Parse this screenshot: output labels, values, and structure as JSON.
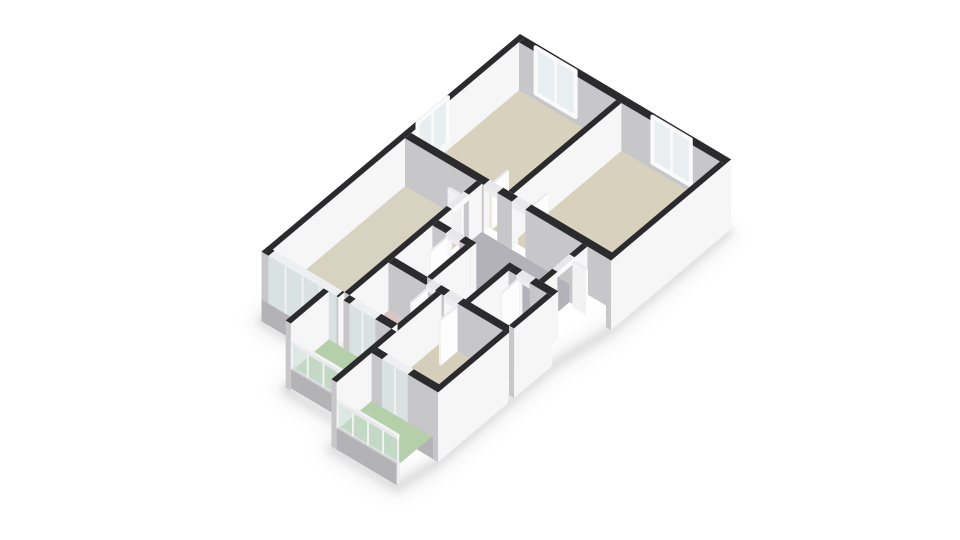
{
  "app": {
    "kind": "3d-floorplan-render",
    "background": "#ffffff"
  },
  "scene": {
    "projection": {
      "ox": 520,
      "oy": 34,
      "ex": [
        32,
        19
      ],
      "ey": [
        -38,
        32
      ],
      "wallH": 48
    },
    "palette": {
      "kinds": {
        "wall": {
          "top": "#2b2b2d",
          "fx": "#f6f6f7",
          "fy": "#c7c7ca"
        },
        "glazed": {
          "top": "#edeff0",
          "fx": "#fbfbfc",
          "fy": "#d9e2e0"
        },
        "leaf": {
          "top": "#ebebed",
          "fx": "#fdfdfd",
          "fy": "#f2f2f3"
        },
        "header": {
          "top": "#e8e8ea",
          "fx": "#fbfbfc",
          "fy": "#ededef"
        },
        "plinth": {
          "top": "#c9c9cc",
          "fx": "#ededef",
          "fy": "#b3b3b6"
        },
        "rail": {
          "top": "#f3f3f4",
          "fx": "#ffffff",
          "fy": "#e9e9eb"
        }
      },
      "windowGlass": "#e9eef0",
      "windowFrame": "#fafafa",
      "railGlass": "rgba(205,222,213,0.62)",
      "railGlassEdge": "#e6ebe8",
      "railPost": "#f0f1f0",
      "shadow": "#9b9b9b"
    },
    "floors": [
      {
        "id": "floor-bedroom-top-left",
        "color": "#d8d1bd",
        "rect": [
          0.16,
          0.16,
          3.2,
          3.0
        ]
      },
      {
        "id": "floor-bedroom-top-right",
        "color": "#d8d1bd",
        "rect": [
          3.36,
          0.16,
          6.44,
          3.0
        ]
      },
      {
        "id": "floor-living-room",
        "color": "#d8d2c0",
        "rect": [
          0.16,
          3.16,
          2.4,
          6.64
        ]
      },
      {
        "id": "floor-hallway-main",
        "color": "#b3b2b9",
        "rect": [
          2.56,
          3.16,
          5.7,
          4.3
        ]
      },
      {
        "id": "floor-hallway-arm",
        "color": "#b3b2b9",
        "rect": [
          3.74,
          4.3,
          4.78,
          5.46
        ]
      },
      {
        "id": "floor-bathroom",
        "color": "#b7cdd9",
        "rect": [
          2.56,
          4.46,
          3.58,
          5.46
        ]
      },
      {
        "id": "floor-toilet",
        "color": "#b7cdd9",
        "rect": [
          4.94,
          4.46,
          6.14,
          5.46
        ]
      },
      {
        "id": "floor-bedroom-pink",
        "color": "#d8c6c3",
        "rect": [
          2.56,
          5.62,
          4.06,
          6.64
        ]
      },
      {
        "id": "floor-bedroom-bottom",
        "color": "#d5cebb",
        "rect": [
          4.22,
          5.62,
          6.14,
          7.3
        ]
      },
      {
        "id": "floor-balcony-upper",
        "color": "#b4cfaa",
        "rect": [
          2.1,
          6.8,
          4.06,
          7.72
        ]
      },
      {
        "id": "floor-balcony-lower",
        "color": "#b4cfaa",
        "rect": [
          4.22,
          7.46,
          6.1,
          8.3
        ]
      }
    ],
    "walls": [
      {
        "id": "wall-envelope-nw",
        "box": [
          0,
          0,
          0.16,
          6.8
        ],
        "z": [
          -0.45,
          1
        ]
      },
      {
        "id": "wall-envelope-ne",
        "box": [
          0.16,
          0,
          6.6,
          0.16
        ],
        "z": [
          -0.45,
          1
        ]
      },
      {
        "id": "wall-envelope-east",
        "box": [
          6.44,
          0.16,
          6.6,
          3.16
        ],
        "z": [
          -0.45,
          1
        ]
      },
      {
        "id": "wall-topblock-south-1",
        "box": [
          0.16,
          3.0,
          2.62,
          3.16
        ]
      },
      {
        "id": "wall-topblock-south-2",
        "box": [
          3.04,
          3.0,
          3.5,
          3.16
        ]
      },
      {
        "id": "wall-topblock-south-3",
        "box": [
          3.92,
          3.0,
          6.6,
          3.16
        ]
      },
      {
        "id": "wall-bedroom-divider",
        "box": [
          3.2,
          0.16,
          3.36,
          3.0
        ]
      },
      {
        "id": "wall-living-east-1",
        "box": [
          2.4,
          3.16,
          2.56,
          3.5
        ]
      },
      {
        "id": "wall-living-east-2",
        "box": [
          2.4,
          3.95,
          2.56,
          6.64
        ]
      },
      {
        "id": "wall-bathroom-north-1",
        "box": [
          2.56,
          4.3,
          2.98,
          4.46
        ]
      },
      {
        "id": "wall-bathroom-north-2",
        "box": [
          3.4,
          4.3,
          3.74,
          4.46
        ]
      },
      {
        "id": "wall-toilet-north-1",
        "box": [
          4.94,
          4.3,
          5.18,
          4.46
        ]
      },
      {
        "id": "wall-toilet-north-2",
        "box": [
          5.6,
          4.3,
          6.3,
          4.46
        ]
      },
      {
        "id": "wall-hall-east-1",
        "box": [
          5.7,
          3.16,
          5.86,
          3.5
        ]
      },
      {
        "id": "wall-hall-east-2",
        "box": [
          5.7,
          3.95,
          5.86,
          4.3
        ]
      },
      {
        "id": "wall-bathroom-east",
        "box": [
          3.58,
          4.46,
          3.74,
          5.46
        ]
      },
      {
        "id": "wall-arm-toilet",
        "box": [
          4.78,
          4.3,
          4.94,
          5.46
        ]
      },
      {
        "id": "wall-south-band-1",
        "box": [
          2.56,
          5.46,
          3.74,
          5.62
        ]
      },
      {
        "id": "wall-south-band-2",
        "box": [
          4.02,
          5.46,
          4.3,
          5.62
        ]
      },
      {
        "id": "wall-south-band-3",
        "box": [
          4.72,
          5.46,
          6.3,
          5.62
        ]
      },
      {
        "id": "wall-toilet-east",
        "box": [
          6.14,
          4.46,
          6.3,
          5.46
        ],
        "z": [
          -0.45,
          1
        ]
      },
      {
        "id": "wall-bedroom-bottom-east",
        "box": [
          6.14,
          5.62,
          6.3,
          7.46
        ],
        "z": [
          -0.45,
          1
        ]
      },
      {
        "id": "wall-pink-bottom-divider",
        "box": [
          4.06,
          5.62,
          4.22,
          6.8
        ]
      },
      {
        "id": "wall-balcony-divider",
        "box": [
          4.06,
          6.8,
          4.22,
          8.38
        ],
        "z": [
          -0.4,
          1
        ]
      },
      {
        "id": "plinth-living-sw",
        "box": [
          0,
          6.64,
          2.4,
          6.8
        ],
        "z": [
          -0.45,
          0.03
        ],
        "kind": "plinth"
      },
      {
        "id": "wall-living-sw-1",
        "box": [
          0,
          6.64,
          0.22,
          6.8
        ]
      },
      {
        "id": "glazing-living-sw",
        "box": [
          0.22,
          6.64,
          2.34,
          6.8
        ],
        "kind": "glazed",
        "posts": 4
      },
      {
        "id": "wall-living-sw-2",
        "box": [
          2.34,
          6.64,
          2.4,
          6.8
        ]
      },
      {
        "id": "wall-pink-south-1",
        "box": [
          2.56,
          6.64,
          2.75,
          6.8
        ]
      },
      {
        "id": "glazing-pink-balcony-door",
        "box": [
          2.75,
          6.64,
          3.55,
          6.8
        ],
        "kind": "glazed",
        "posts": 2
      },
      {
        "id": "wall-pink-south-2",
        "box": [
          3.55,
          6.64,
          4.06,
          6.8
        ]
      },
      {
        "id": "wall-balcony-west-end",
        "box": [
          1.94,
          6.8,
          2.1,
          7.8
        ],
        "z": [
          -0.4,
          1
        ]
      },
      {
        "id": "plinth-bedroom-bottom-s",
        "box": [
          4.22,
          7.3,
          6.3,
          7.46
        ],
        "z": [
          -0.45,
          0.03
        ],
        "kind": "plinth"
      },
      {
        "id": "wall-bedroom-bottom-s-1",
        "box": [
          4.22,
          7.3,
          4.55,
          7.46
        ]
      },
      {
        "id": "glazing-bottom-balcony-door",
        "box": [
          4.55,
          7.3,
          5.35,
          7.46
        ],
        "kind": "glazed",
        "posts": 2
      },
      {
        "id": "wall-bedroom-bottom-s-2",
        "box": [
          5.35,
          7.3,
          6.3,
          7.46
        ]
      }
    ],
    "headers": [
      {
        "id": "header-bedroom-top-left",
        "box": [
          2.62,
          3.0,
          3.04,
          3.16
        ]
      },
      {
        "id": "header-bedroom-top-right",
        "box": [
          3.5,
          3.0,
          3.92,
          3.16
        ]
      },
      {
        "id": "header-bathroom",
        "box": [
          2.98,
          4.3,
          3.4,
          4.46
        ]
      },
      {
        "id": "header-toilet",
        "box": [
          5.18,
          4.3,
          5.6,
          4.46
        ]
      },
      {
        "id": "header-living",
        "box": [
          2.4,
          3.5,
          2.56,
          3.95
        ]
      },
      {
        "id": "header-entry",
        "box": [
          5.7,
          3.5,
          5.86,
          3.95
        ]
      },
      {
        "id": "header-pink-bedroom",
        "box": [
          3.74,
          5.46,
          4.02,
          5.62
        ]
      },
      {
        "id": "header-bottom-bedroom",
        "box": [
          4.3,
          5.46,
          4.72,
          5.62
        ]
      }
    ],
    "doorLeaves": [
      {
        "id": "door-bedroom-top-left",
        "box": [
          2.64,
          2.56,
          2.695,
          3.0
        ]
      },
      {
        "id": "door-bedroom-top-right",
        "box": [
          3.865,
          2.56,
          3.92,
          3.0
        ]
      },
      {
        "id": "door-bathroom",
        "box": [
          2.98,
          4.46,
          3.035,
          4.9
        ]
      },
      {
        "id": "door-toilet",
        "box": [
          5.2,
          4.46,
          5.255,
          4.9
        ]
      },
      {
        "id": "door-living",
        "box": [
          1.96,
          3.5,
          2.4,
          3.555
        ]
      },
      {
        "id": "door-entry",
        "box": [
          5.86,
          3.5,
          6.28,
          3.555
        ]
      },
      {
        "id": "door-pink-bedroom",
        "box": [
          3.74,
          5.62,
          3.795,
          6.04
        ]
      },
      {
        "id": "door-bottom-bedroom",
        "box": [
          4.665,
          5.62,
          4.72,
          6.06
        ]
      }
    ],
    "windows": [
      {
        "id": "window-top-left-ne",
        "axis": "x",
        "plane": 0.18,
        "from": 0.7,
        "to": 1.95,
        "z": [
          0.16,
          1.12
        ]
      },
      {
        "id": "window-top-right-ne",
        "axis": "x",
        "plane": 0.18,
        "from": 4.35,
        "to": 5.55,
        "z": [
          0.16,
          1.12
        ]
      },
      {
        "id": "window-top-left-nw",
        "axis": "y",
        "plane": 0.18,
        "from": 2.05,
        "to": 2.85,
        "z": [
          0.16,
          1.12
        ]
      }
    ],
    "railings": [
      {
        "id": "railing-balcony-upper",
        "y": 7.72,
        "from": 2.1,
        "to": 4.06,
        "base": [
          -0.35,
          0.04
        ],
        "glass": [
          0.05,
          0.55
        ],
        "rail": [
          0.55,
          0.62
        ],
        "posts": 4
      },
      {
        "id": "railing-balcony-lower",
        "y": 8.3,
        "from": 4.22,
        "to": 6.1,
        "base": [
          -0.4,
          0.04
        ],
        "glass": [
          0.05,
          0.55
        ],
        "rail": [
          0.55,
          0.62
        ],
        "posts": 4
      }
    ],
    "shadowPath": [
      [
        0,
        0
      ],
      [
        0,
        6.8
      ],
      [
        1.94,
        6.8
      ],
      [
        1.94,
        7.8
      ],
      [
        4.06,
        7.8
      ],
      [
        4.06,
        8.38
      ],
      [
        6.1,
        8.38
      ],
      [
        6.3,
        7.46
      ],
      [
        6.3,
        4.46
      ],
      [
        6.6,
        3.16
      ],
      [
        6.6,
        0
      ]
    ]
  }
}
